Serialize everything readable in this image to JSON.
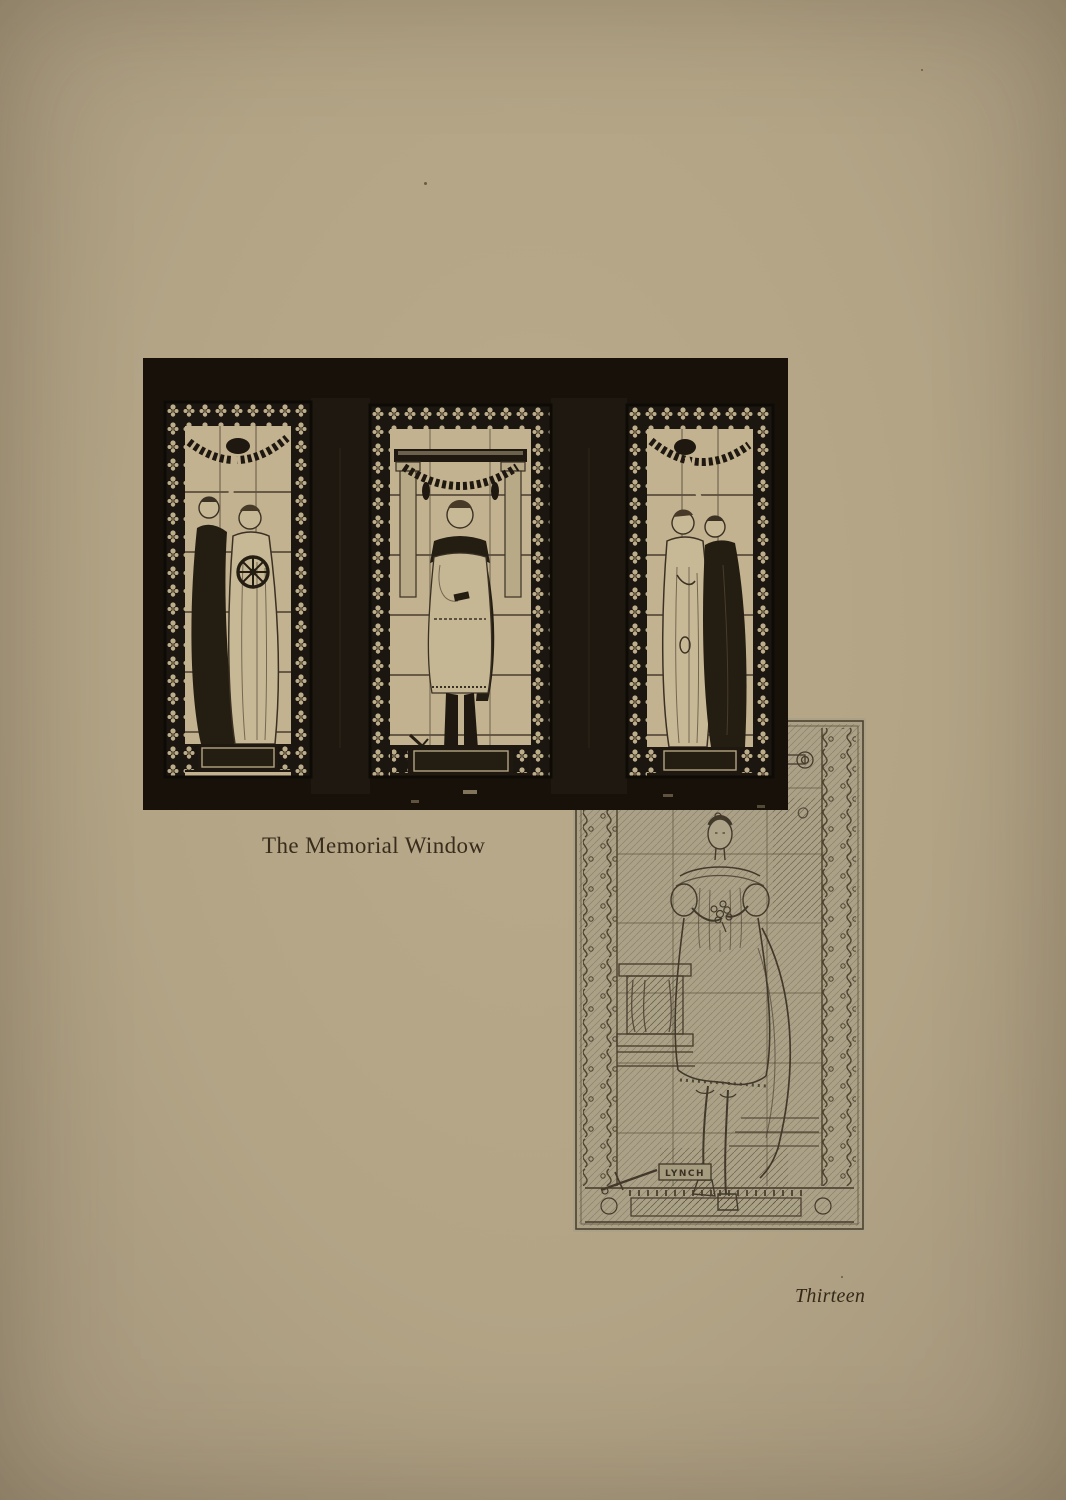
{
  "page": {
    "paper_color": "#b3a486",
    "ink_color": "#382d1c"
  },
  "photo_figure": {
    "caption": "The Memorial Window",
    "alt": "Photograph of a three-panel stained glass memorial window set in a dark wall",
    "panels": [
      {
        "position": "left",
        "content": "Two classical female figures, one raising a wreath beneath a garland, one holding a spoked wheel"
      },
      {
        "position": "center",
        "content": "Young man in Roman tunic and mantle standing between two columns beneath a garland swag"
      },
      {
        "position": "right",
        "content": "Two classical female figures, one bowed in a light robe, one in a dark robe raising a wreath"
      }
    ]
  },
  "sketch_figure": {
    "alt": "Pencil working study for the central panel of the memorial window",
    "signature": "LYNCH"
  },
  "footer": {
    "page_number": "Thirteen"
  }
}
